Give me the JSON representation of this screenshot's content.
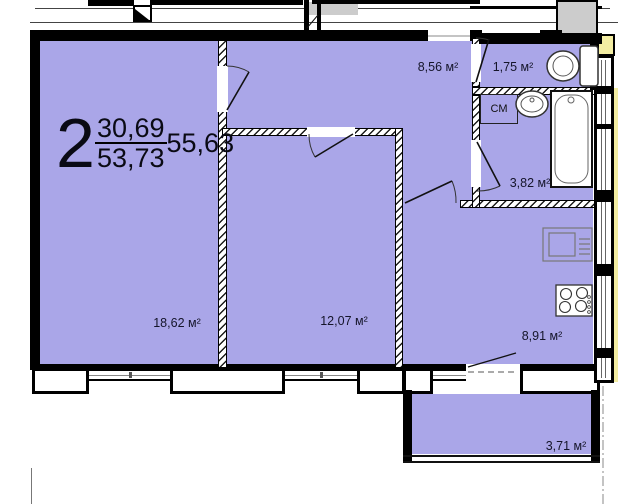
{
  "apartment_label": {
    "rooms_count": "2",
    "living_area": "30,69",
    "total_area": "53,73",
    "total_with_balcony": "55,63"
  },
  "room_labels": {
    "living_room": "18,62 м²",
    "bedroom": "12,07 м²",
    "hall": "8,56 м²",
    "wc": "1,75 м²",
    "bathroom": "3,82 м²",
    "kitchen": "8,91 м²",
    "balcony": "3,71 м²"
  },
  "fixtures": {
    "washing_machine": "СМ"
  },
  "colors": {
    "room_fill": "#aaa6e8",
    "wall": "#000000",
    "stair_gray": "#cccccc",
    "accent_yellow": "#f3eda2"
  }
}
